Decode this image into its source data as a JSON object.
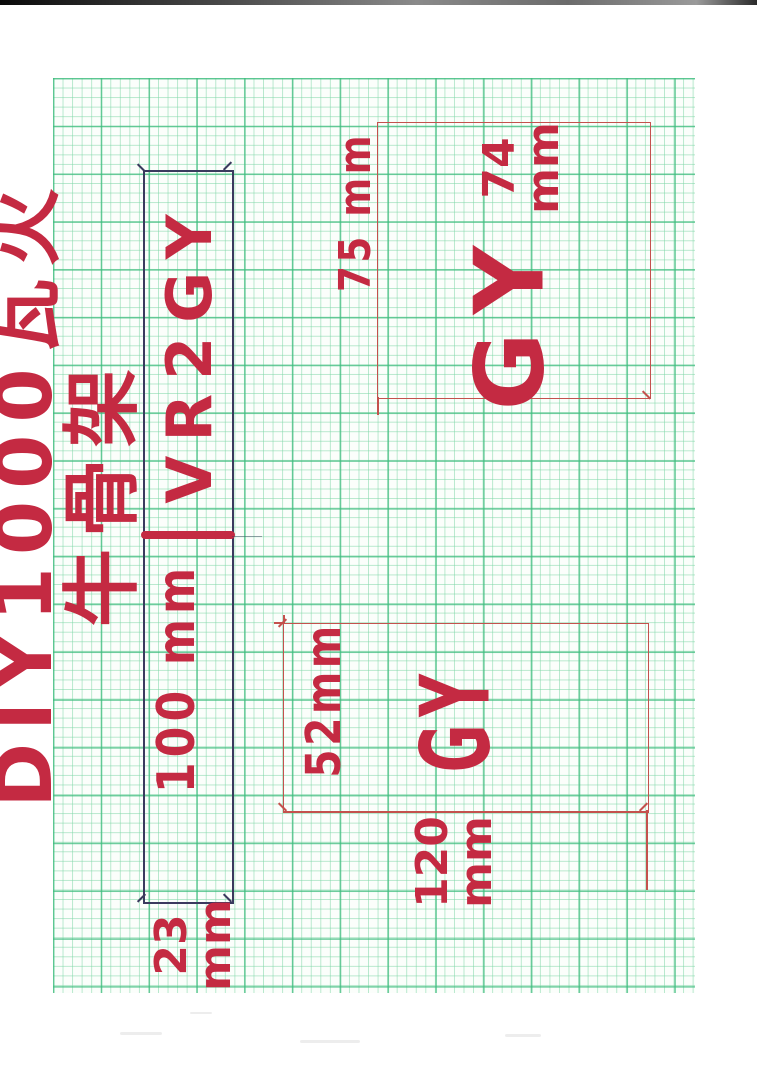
{
  "document": {
    "title": "DIY1000瓦火牛骨架"
  },
  "pieces": {
    "strip": {
      "label": "VR2GY",
      "length_dim": "100 mm",
      "width_dim": "23\nmm"
    },
    "square": {
      "label": "GY",
      "side_dim": "75 mm",
      "top_dim": "74\nmm"
    },
    "rect": {
      "label": "GY",
      "width_dim": "52mm",
      "length_dim": "120\nmm"
    }
  },
  "colors": {
    "marker_red": "#c42a42",
    "pen_red": "#c4514d",
    "pencil_blue": "#3a3a5e",
    "grid_green_minor": "#7ed6a6",
    "grid_green_major": "#3ebc7e",
    "paper_white": "#ffffff",
    "grid_paper_bg": "#fbfefb"
  }
}
